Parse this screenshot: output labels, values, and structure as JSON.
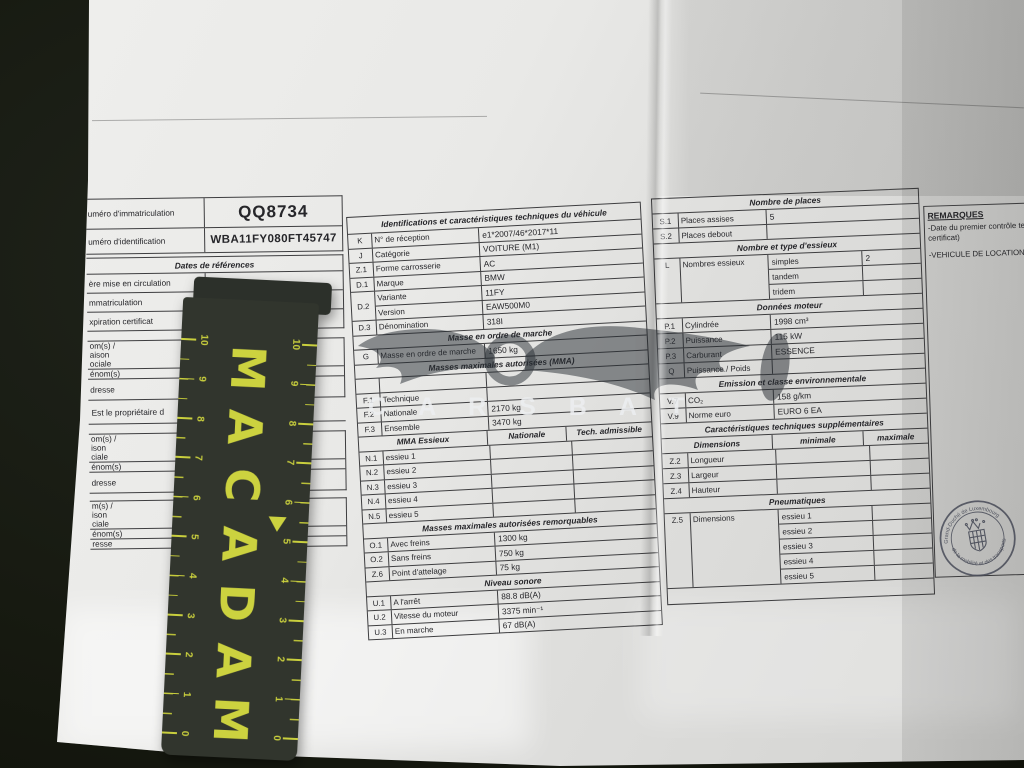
{
  "left_table": {
    "registration_label": "uméro d'immatriculation",
    "registration_value": "QQ8734",
    "vin_label": "uméro d'identification",
    "vin_value": "WBA11FY080FT45747",
    "dates_header": "Dates de références",
    "date_rows": [
      "ère mise en circulation",
      "mmatriculation",
      "xpiration certificat"
    ],
    "owner1_rows": [
      {
        "label": "om(s) /\naison\nociale",
        "value": "SIXT S.à r."
      },
      {
        "label": "énom(s)",
        "value": ""
      },
      {
        "label": "dresse",
        "value": "Aéroport de\n1110 Finde"
      }
    ],
    "proprietor_note": "Est le propriétaire d",
    "owner2_rows": [
      {
        "label": "om(s) /\nison\nciale",
        "value": "SIXT S.à r."
      },
      {
        "label": "énom(s)",
        "value": ""
      },
      {
        "label": "dresse",
        "value": "Aéroport de\n1110 Finde"
      }
    ],
    "owner3_rows": [
      {
        "label": "m(s) /\nison\nciale",
        "value": ""
      },
      {
        "label": "énom(s)",
        "value": ""
      },
      {
        "label": "resse",
        "value": ""
      }
    ]
  },
  "middle_table": {
    "title": "Identifications et caractéristiques techniques du véhicule",
    "id_rows": [
      [
        "K",
        "N° de réception",
        "e1*2007/46*2017*11"
      ],
      [
        "J",
        "Catégorie",
        "VOITURE (M1)"
      ],
      [
        "Z.1",
        "Forme carrosserie",
        "AC"
      ],
      [
        "D.1",
        "Marque",
        "BMW"
      ]
    ],
    "d2_code": "D.2",
    "d2_rows": [
      [
        "Variante",
        "11FY"
      ],
      [
        "Version",
        "EAW500M0"
      ]
    ],
    "d3_row": [
      "D.3",
      "Dénomination",
      "318I"
    ],
    "mass_header": "Masse en ordre de marche",
    "mass_row": [
      "G",
      "Masse en ordre de marche",
      "1650 kg"
    ],
    "mma_header": "Masses maximales autorisées (MMA)",
    "mma_rows": [
      [
        "",
        "",
        ""
      ],
      [
        "F.1",
        "Technique",
        ""
      ],
      [
        "F.2",
        "Nationale",
        "2170 kg"
      ],
      [
        "F.3",
        "Ensemble",
        "3470 kg"
      ]
    ],
    "axle_subheader": [
      "MMA Essieux",
      "Nationale",
      "Tech. admissible"
    ],
    "axle_rows": [
      [
        "N.1",
        "essieu 1"
      ],
      [
        "N.2",
        "essieu 2"
      ],
      [
        "N.3",
        "essieu 3"
      ],
      [
        "N.4",
        "essieu 4"
      ],
      [
        "N.5",
        "essieu 5"
      ]
    ],
    "tow_header": "Masses maximales autorisées remorquables",
    "tow_rows": [
      [
        "O.1",
        "Avec freins",
        "1300 kg"
      ],
      [
        "O.2",
        "Sans freins",
        "750 kg"
      ],
      [
        "Z.6",
        "Point d'attelage",
        "75 kg"
      ]
    ],
    "noise_header": "Niveau sonore",
    "noise_rows": [
      [
        "U.1",
        "A l'arrêt",
        "88.8 dB(A)"
      ],
      [
        "U.2",
        "Vitesse du moteur",
        "3375 min⁻¹"
      ],
      [
        "U.3",
        "En marche",
        "67 dB(A)"
      ]
    ]
  },
  "right_table": {
    "seats_header": "Nombre de places",
    "seats_rows": [
      [
        "S.1",
        "Places assises",
        "5"
      ],
      [
        "S.2",
        "Places debout",
        ""
      ]
    ],
    "axle_type_header": "Nombre et type d'essieux",
    "axle_code": "L",
    "axle_label": "Nombres essieux",
    "axle_type_rows": [
      [
        "simples",
        "2"
      ],
      [
        "tandem",
        ""
      ],
      [
        "tridem",
        ""
      ]
    ],
    "engine_header": "Données moteur",
    "engine_rows": [
      [
        "P.1",
        "Cylindrée",
        "1998 cm³"
      ],
      [
        "P.2",
        "Puissance",
        "115 kW"
      ],
      [
        "P.3",
        "Carburant",
        "ESSENCE"
      ],
      [
        "Q",
        "Puissance / Poids",
        ""
      ]
    ],
    "emission_header": "Emission et classe environnementale",
    "emission_rows": [
      [
        "V.7",
        "CO₂",
        "158 g/km"
      ],
      [
        "V.9",
        "Norme euro",
        "EURO 6 EA"
      ]
    ],
    "extra_header": "Caractéristiques techniques supplémentaires",
    "dim_subheader": [
      "Dimensions",
      "minimale",
      "maximale"
    ],
    "dim_rows": [
      [
        "Z.2",
        "Longueur"
      ],
      [
        "Z.3",
        "Largeur"
      ],
      [
        "Z.4",
        "Hauteur"
      ]
    ],
    "tyre_header": "Pneumatiques",
    "tyre_code": "Z.5",
    "tyre_label": "Dimensions",
    "tyre_rows": [
      [
        "essieu 1",
        ""
      ],
      [
        "essieu 2",
        ""
      ],
      [
        "essieu 3",
        ""
      ],
      [
        "essieu 4",
        ""
      ],
      [
        "essieu 5",
        ""
      ]
    ]
  },
  "remarks": {
    "title": "REMARQUES",
    "lines": [
      "-Date du premier contrôle tech",
      "certificat)",
      "-VEHICULE DE LOCATION S"
    ]
  },
  "stamp": {
    "text_top": "Grand-Duché de Luxembourg",
    "text_bottom": "de la mobilité et des transports"
  },
  "watermark": {
    "text": "C A R S B A T"
  },
  "ruler": {
    "brand_letters": [
      "M",
      "A",
      "C",
      "A",
      "D",
      "A",
      "M"
    ],
    "numbers": [
      "10",
      "9",
      "8",
      "7",
      "6",
      "5",
      "4",
      "3",
      "2",
      "1",
      "0"
    ]
  }
}
